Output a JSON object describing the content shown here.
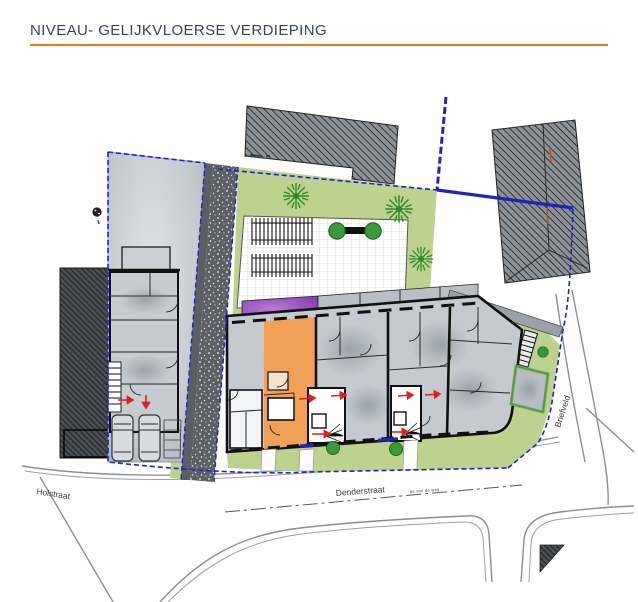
{
  "header": {
    "title": "NIVEAU- GELIJKVLOERSE VERDIEPING"
  },
  "plan": {
    "streets": {
      "holstraat": "Holstraat",
      "denderstraat": "Denderstraat",
      "briefveld": "Briefveld"
    },
    "road_axis_label": "as van de weg"
  },
  "colors": {
    "accent": "#e07c1a",
    "green": "#bdd28e",
    "orange": "#f0a057",
    "purple": "#8a3cb4",
    "boundary": "#2222c0",
    "arrow": "#e02020",
    "tree": "#2e8b2e"
  }
}
